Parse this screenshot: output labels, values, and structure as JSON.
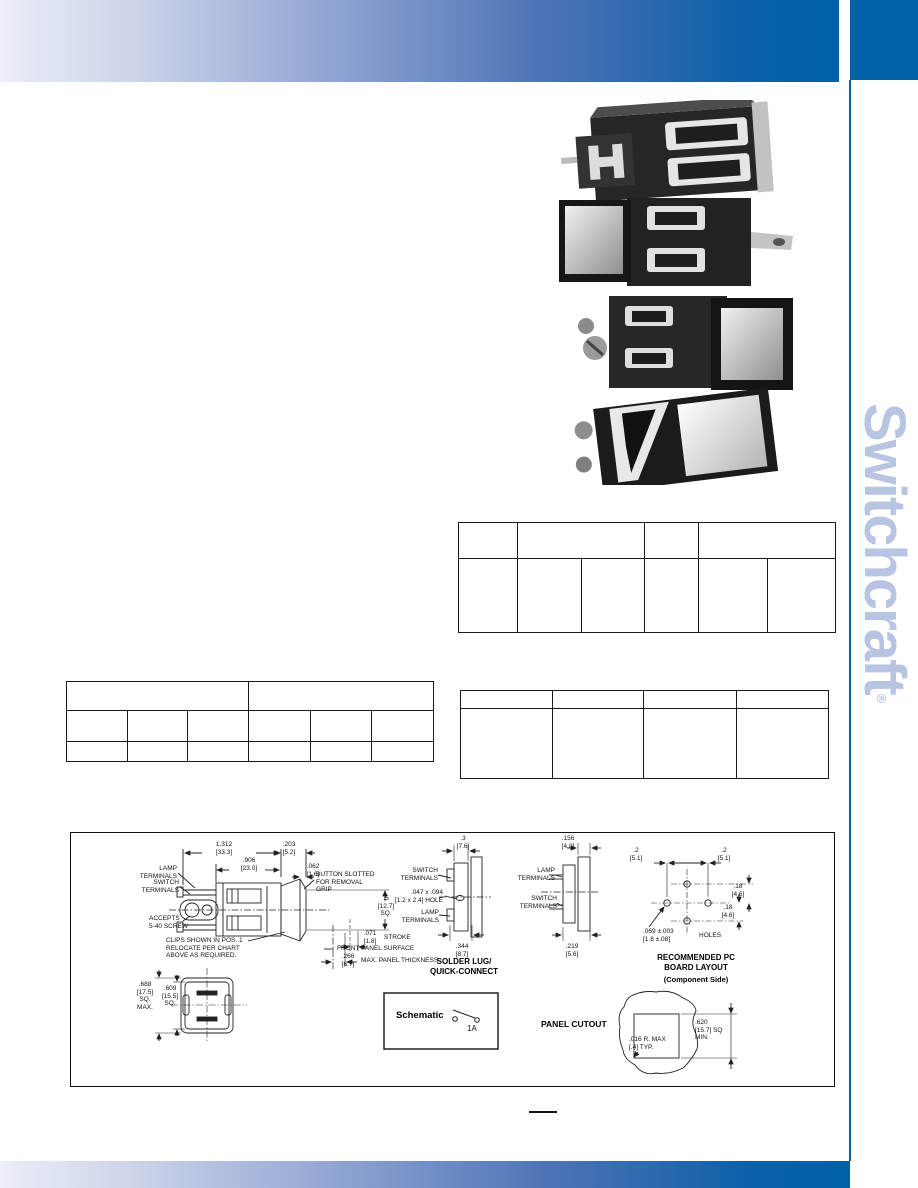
{
  "theme": {
    "accent": "#0060A8",
    "brand_text_color": "#B7C5E2"
  },
  "brand": {
    "name": "Switchcraft",
    "registered": "®"
  },
  "drawings": {
    "side_view": {
      "dim_total": "1.312\n[33.3]",
      "dim_button": ".203\n[5.2]",
      "dim_body": ".906\n[23.0]",
      "dim_bezel": ".062\n[1.6]",
      "label_lamp": "LAMP\nTERMINALS",
      "label_switch": "SWITCH\nTERMINALS",
      "label_screw": "ACCEPTS\n5-40 SCREW",
      "label_clips": "CLIPS SHOWN IN POS. 1\nRELOCATE PER CHART\nABOVE AS REQUIRED.",
      "label_button_slot": "BUTTON SLOTTED\nFOR REMOVAL\nGRIP",
      "dim_square": ".5\n[12.7]\nSQ.",
      "dim_stroke": ".071\n[1.8]",
      "label_stroke": "STROKE",
      "label_front_panel": "FRONT PANEL SURFACE",
      "dim_panel": ".266\n[6.7]",
      "label_panel_thickness": "MAX. PANEL THICKNESS"
    },
    "solder_lug": {
      "dim_top": ".3\n[7.6]",
      "label_switch": "SWITCH\nTERMINALS",
      "label_hole": ".047 x .094\n[1.2 x 2.4] HOLE",
      "label_lamp": "LAMP\nTERMINALS",
      "dim_bottom": ".344\n[8.7]",
      "caption": "SOLDER LUG/\nQUICK-CONNECT"
    },
    "pc_terminals": {
      "dim_top": ".156\n[4.0]",
      "label_lamp": "LAMP\nTERMINALS",
      "label_switch": "SWITCH\nTERMINALS",
      "dim_bottom": ".219\n[5.6]"
    },
    "pcb_layout": {
      "dim_left": ".2\n[5.1]",
      "dim_right": ".2\n[5.1]",
      "dim_v1": ".18\n[4.6]",
      "dim_v2": ".18\n[4.6]",
      "label_holes": ".069 ±.003\n[1.8 ±.08]",
      "label_holes_suffix": "HOLES",
      "caption": "RECOMMENDED PC\nBOARD LAYOUT",
      "caption_sub": "(Component Side)"
    },
    "front_view": {
      "dim_outer": ".688\n[17.5]\nSQ.\nMAX.",
      "dim_inner": ".609\n[15.5]\nSQ."
    },
    "schematic": {
      "label": "Schematic",
      "rating": "1A"
    },
    "panel_cutout": {
      "label": "PANEL CUTOUT",
      "dim_square": ".620\n[15.7] SQ\nMIN.",
      "dim_radius": ".016 R. MAX\n[.4]  TYP."
    }
  }
}
